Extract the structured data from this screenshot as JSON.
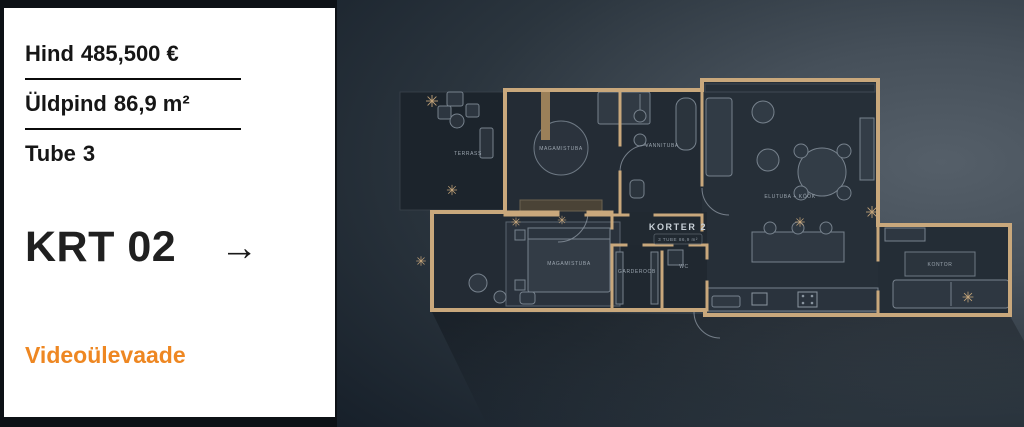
{
  "card": {
    "specs": [
      {
        "label": "Hind",
        "value": "485,500 €"
      },
      {
        "label": "Üldpind",
        "value": "86,9 m²"
      },
      {
        "label": "Tube",
        "value": "3"
      }
    ],
    "title": "KRT 02",
    "arrow_icon": "→",
    "video_link": "Videoülevaade"
  },
  "colors": {
    "accent_orange": "#EE8722",
    "card_background": "#FFFFFF",
    "text_dark": "#161616",
    "plan_wall_tan": "#C9A87C",
    "plan_bg_dark": "#17202A",
    "plan_bg_light": "#555F69",
    "plan_room_fill": "#242C35"
  },
  "floorplan": {
    "title": "KORTER 2",
    "subtitle": "3 TUBE 86,9 m²",
    "rooms": [
      {
        "name": "terrass",
        "label": "TERRASS"
      },
      {
        "name": "magamistuba-1",
        "label": "MAGAMISTUBA"
      },
      {
        "name": "vannituba",
        "label": "VANNITUBA"
      },
      {
        "name": "elutuba-kook",
        "label": "ELUTUBA + KÖÖK"
      },
      {
        "name": "magamistuba-2",
        "label": "MAGAMISTUBA"
      },
      {
        "name": "garderoob",
        "label": "GARDEROOB"
      },
      {
        "name": "wc",
        "label": "WC"
      },
      {
        "name": "kontor",
        "label": "KONTOR"
      }
    ]
  }
}
